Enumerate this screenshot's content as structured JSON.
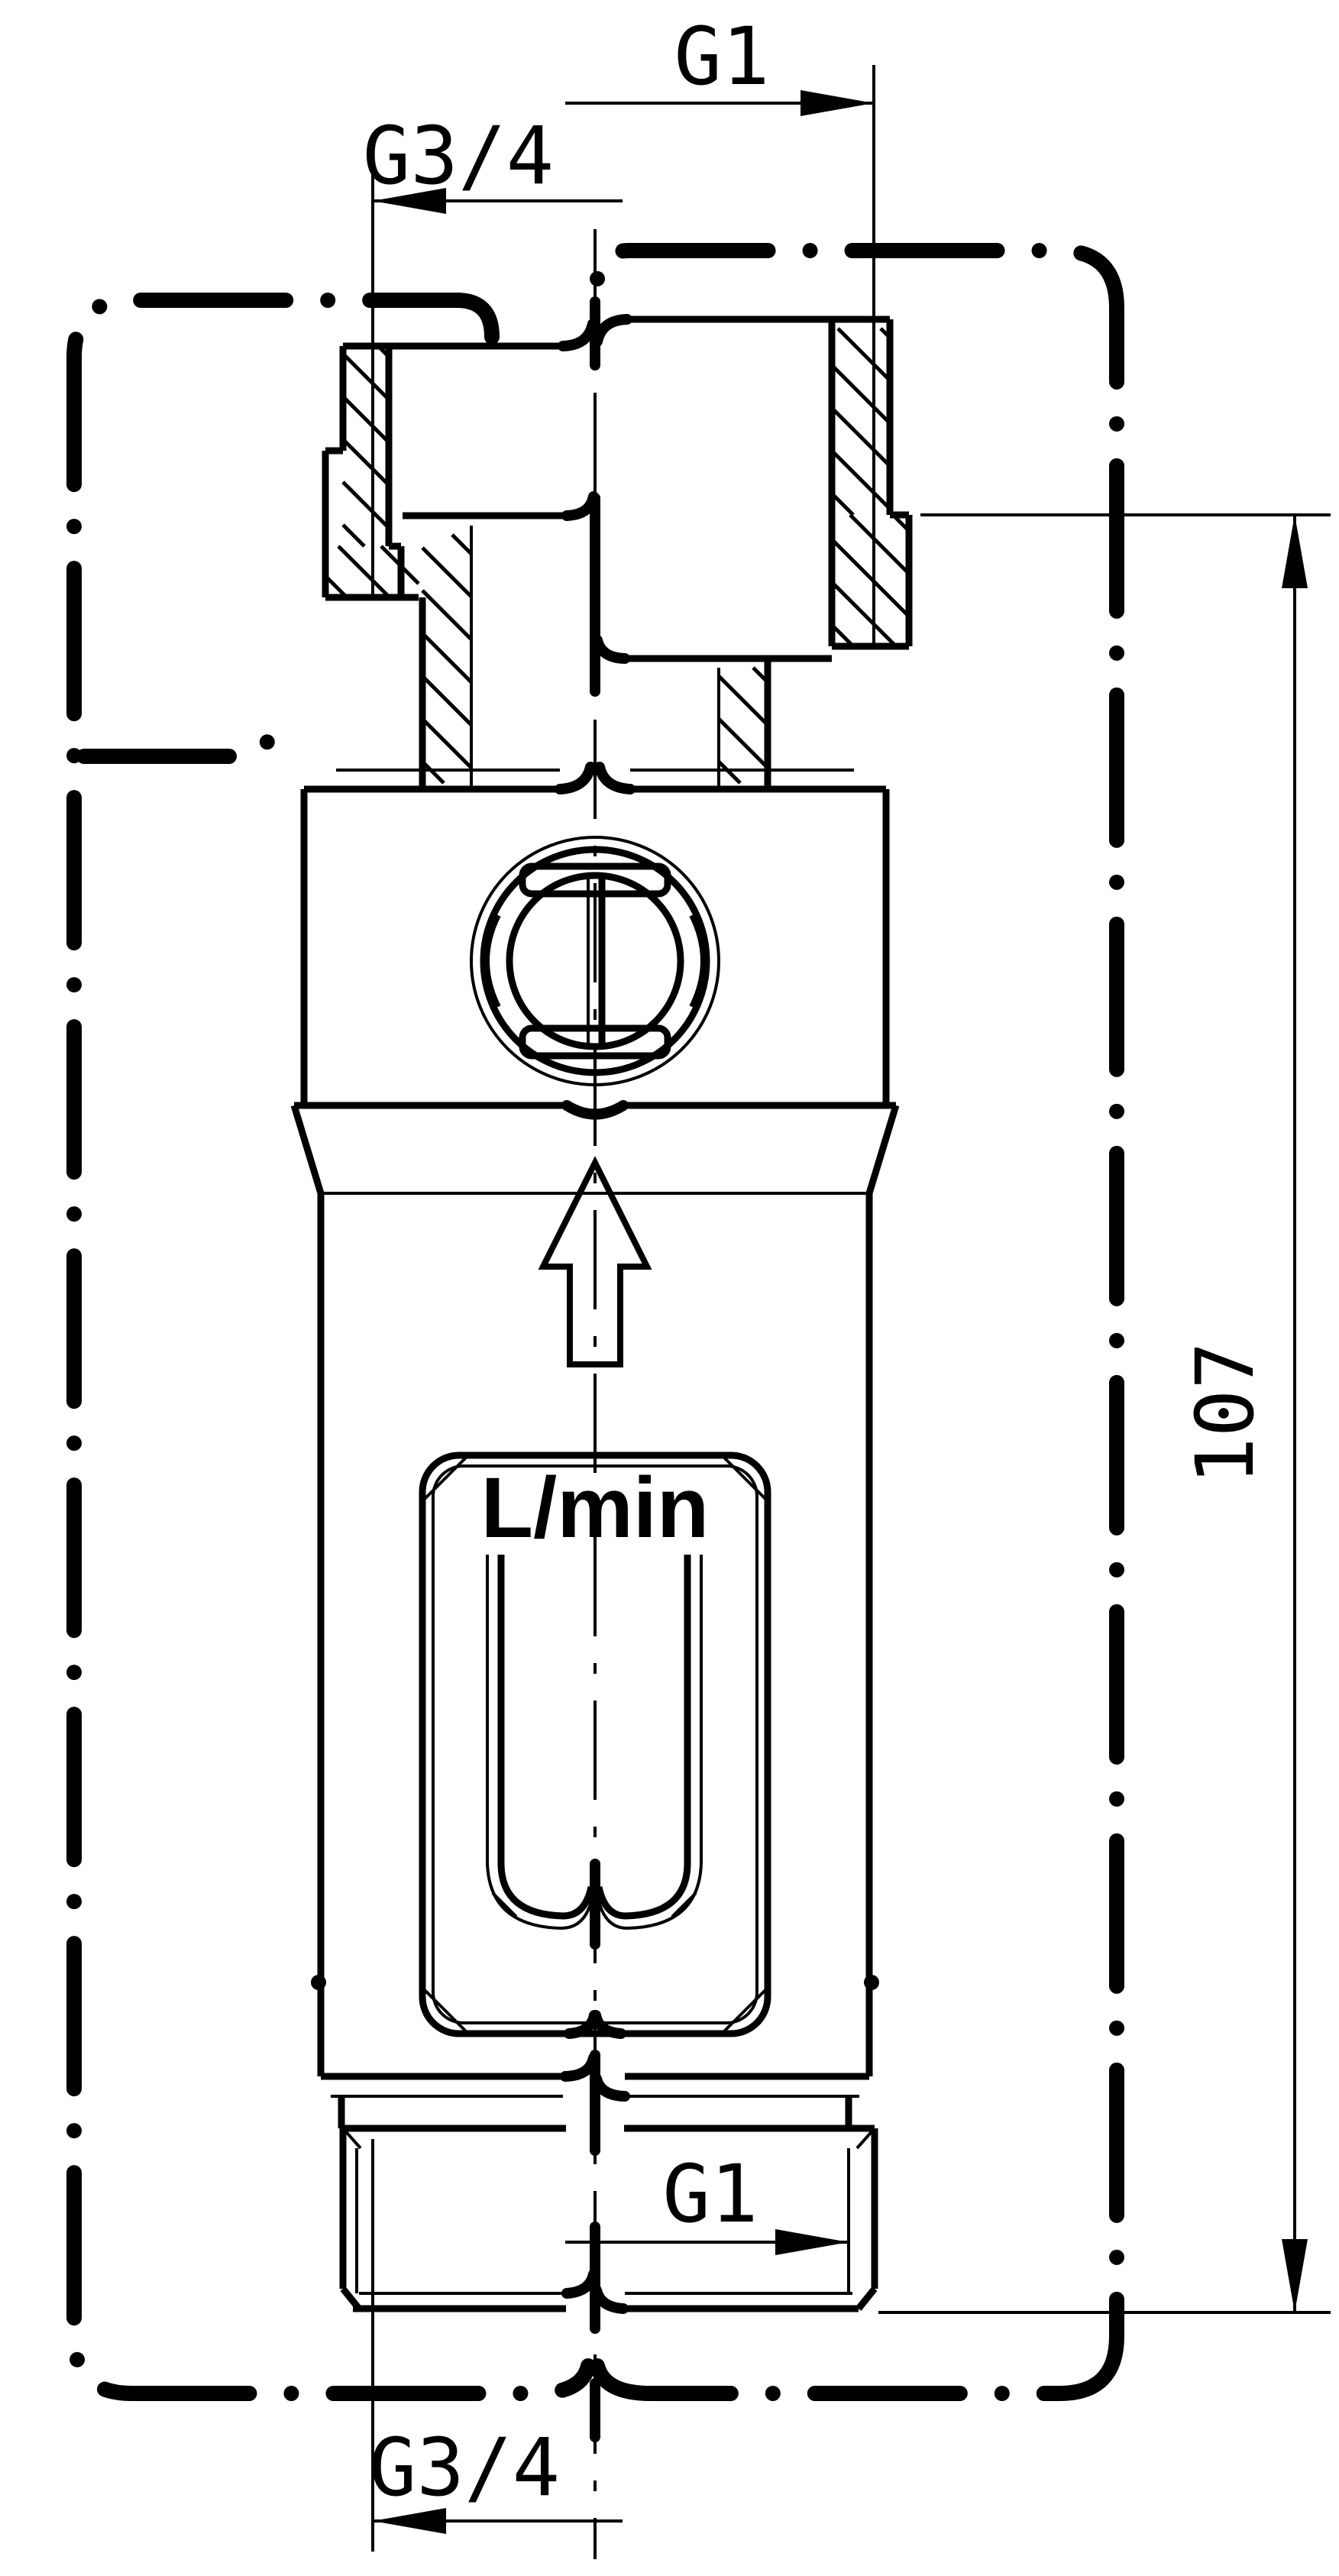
{
  "drawing": {
    "kind": "flow-meter dimensional drawing",
    "background": "#ffffff",
    "line_color": "#000000",
    "labels": {
      "dim_top_right": "G1",
      "dim_top_left": "G3/4",
      "dim_bottom_right": "G1",
      "dim_bottom_left": "G3/4",
      "overall_length": "107",
      "flow_scale_unit": "L/min"
    },
    "scale_tick_pairs": 6
  }
}
